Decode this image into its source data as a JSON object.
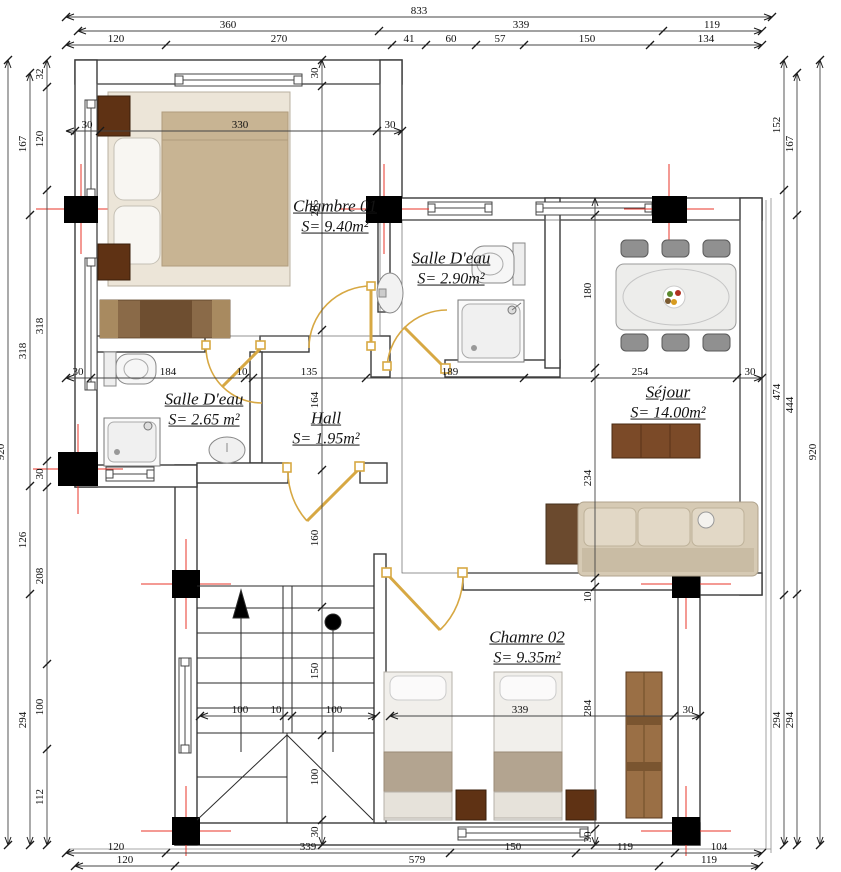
{
  "plan_title": "Floor plan",
  "rooms": [
    {
      "name": "Chambre 01",
      "area": "S= 9.40m²",
      "x": 335,
      "y": 217
    },
    {
      "name": "Salle D'eau",
      "area": "S= 2.90m²",
      "x": 451,
      "y": 269
    },
    {
      "name": "Séjour",
      "area": "S= 14.00m²",
      "x": 668,
      "y": 403
    },
    {
      "name": "Salle D'eau",
      "area": "S= 2.65 m²",
      "x": 204,
      "y": 410
    },
    {
      "name": "Hall",
      "area": "S= 1.95m²",
      "x": 326,
      "y": 429
    },
    {
      "name": "Chamre 02",
      "area": "S= 9.35m²",
      "x": 527,
      "y": 648
    }
  ],
  "colors": {
    "wall": "#3a3a3a",
    "column": "#000000",
    "axis_red": "#e8342a",
    "door": "#d7a843",
    "dim_line": "#444444",
    "dim_text": "#101010",
    "wood_dark": "#5f3214",
    "wood_mid": "#7b4a28",
    "wood_light": "#9a6f45",
    "fabric_beige": "#d6cab4",
    "blanket_tan": "#c8b493"
  },
  "dimensions": {
    "rows": [
      {
        "y": 17,
        "x1": 66,
        "x2": 772,
        "ticks": [
          66,
          772
        ],
        "labels": [
          {
            "p": 419,
            "t": "833"
          }
        ]
      },
      {
        "y": 31,
        "x1": 78,
        "x2": 762,
        "ticks": [
          78,
          379,
          663,
          762
        ],
        "labels": [
          {
            "p": 228,
            "t": "360"
          },
          {
            "p": 521,
            "t": "339"
          },
          {
            "p": 712,
            "t": "119"
          }
        ]
      },
      {
        "y": 45,
        "x1": 66,
        "x2": 762,
        "ticks": [
          66,
          166,
          392,
          426,
          476,
          524,
          650,
          762
        ],
        "labels": [
          {
            "p": 116,
            "t": "120"
          },
          {
            "p": 279,
            "t": "270"
          },
          {
            "p": 409,
            "t": "41"
          },
          {
            "p": 451,
            "t": "60"
          },
          {
            "p": 500,
            "t": "57"
          },
          {
            "p": 587,
            "t": "150"
          },
          {
            "p": 706,
            "t": "134"
          }
        ]
      },
      {
        "y": 131,
        "x1": 66,
        "x2": 402,
        "ticks": [
          75,
          100,
          377,
          402
        ],
        "labels": [
          {
            "p": 87,
            "t": "30"
          },
          {
            "p": 240,
            "t": "330"
          },
          {
            "p": 390,
            "t": "30"
          }
        ]
      },
      {
        "y": 378,
        "x1": 66,
        "x2": 762,
        "ticks": [
          66,
          91,
          245,
          253,
          366,
          524,
          737,
          762
        ],
        "labels": [
          {
            "p": 78,
            "t": "30"
          },
          {
            "p": 168,
            "t": "184"
          },
          {
            "p": 242,
            "t": "10"
          },
          {
            "p": 309,
            "t": "135"
          },
          {
            "p": 450,
            "t": "189"
          },
          {
            "p": 640,
            "t": "254"
          },
          {
            "p": 750,
            "t": "30"
          }
        ]
      },
      {
        "y": 716,
        "x1": 200,
        "x2": 376,
        "ticks": [
          200,
          284,
          292,
          376
        ],
        "labels": [
          {
            "p": 240,
            "t": "100"
          },
          {
            "p": 276,
            "t": "10"
          },
          {
            "p": 334,
            "t": "100"
          }
        ]
      },
      {
        "y": 716,
        "x1": 390,
        "x2": 700,
        "ticks": [
          390,
          674,
          700
        ],
        "labels": [
          {
            "p": 520,
            "t": "339"
          },
          {
            "p": 688,
            "t": "30"
          }
        ]
      },
      {
        "y": 853,
        "x1": 66,
        "x2": 762,
        "ticks": [
          66,
          166,
          450,
          576,
          675,
          762
        ],
        "labels": [
          {
            "p": 116,
            "t": "120"
          },
          {
            "p": 308,
            "t": "339"
          },
          {
            "p": 513,
            "t": "150"
          },
          {
            "p": 625,
            "t": "119"
          },
          {
            "p": 719,
            "t": "104"
          }
        ]
      },
      {
        "y": 866,
        "x1": 75,
        "x2": 759,
        "ticks": [
          75,
          175,
          659,
          759
        ],
        "labels": [
          {
            "p": 125,
            "t": "120"
          },
          {
            "p": 417,
            "t": "579"
          },
          {
            "p": 709,
            "t": "119"
          }
        ]
      }
    ],
    "cols": [
      {
        "x": 8,
        "y1": 60,
        "y2": 845,
        "ticks": [
          60,
          845
        ],
        "labels": [
          {
            "p": 452,
            "t": "920"
          }
        ]
      },
      {
        "x": 30,
        "y1": 73,
        "y2": 845,
        "ticks": [
          73,
          215,
          486,
          594,
          845
        ],
        "labels": [
          {
            "p": 144,
            "t": "167"
          },
          {
            "p": 351,
            "t": "318"
          },
          {
            "p": 540,
            "t": "126"
          },
          {
            "p": 720,
            "t": "294"
          }
        ]
      },
      {
        "x": 47,
        "y1": 60,
        "y2": 845,
        "ticks": [
          60,
          87,
          190,
          461,
          487,
          664,
          749,
          845
        ],
        "labels": [
          {
            "p": 74,
            "t": "32"
          },
          {
            "p": 139,
            "t": "120"
          },
          {
            "p": 326,
            "t": "318"
          },
          {
            "p": 474,
            "t": "30"
          },
          {
            "p": 576,
            "t": "208"
          },
          {
            "p": 707,
            "t": "100"
          },
          {
            "p": 797,
            "t": "112"
          }
        ]
      },
      {
        "x": 784,
        "y1": 60,
        "y2": 845,
        "ticks": [
          60,
          190,
          595,
          845
        ],
        "labels": [
          {
            "p": 125,
            "t": "152"
          },
          {
            "p": 392,
            "t": "474"
          },
          {
            "p": 720,
            "t": "294"
          }
        ]
      },
      {
        "x": 797,
        "y1": 73,
        "y2": 845,
        "ticks": [
          73,
          215,
          594,
          845
        ],
        "labels": [
          {
            "p": 144,
            "t": "167"
          },
          {
            "p": 405,
            "t": "444"
          },
          {
            "p": 720,
            "t": "294"
          }
        ]
      },
      {
        "x": 820,
        "y1": 60,
        "y2": 845,
        "ticks": [
          60,
          845
        ],
        "labels": [
          {
            "p": 452,
            "t": "920"
          }
        ]
      },
      {
        "x": 322,
        "y1": 60,
        "y2": 845,
        "ticks": [
          60,
          86,
          330,
          470,
          607,
          735,
          820,
          845
        ],
        "labels": [
          {
            "p": 73,
            "t": "30"
          },
          {
            "p": 208,
            "t": "285"
          },
          {
            "p": 400,
            "t": "164"
          },
          {
            "p": 538,
            "t": "160"
          },
          {
            "p": 671,
            "t": "150"
          },
          {
            "p": 777,
            "t": "100"
          },
          {
            "p": 832,
            "t": "30"
          }
        ]
      },
      {
        "x": 595,
        "y1": 198,
        "y2": 845,
        "ticks": [
          215,
          368,
          378,
          578,
          587,
          829,
          845
        ],
        "labels": [
          {
            "p": 291,
            "t": "180"
          },
          {
            "p": 478,
            "t": "234"
          },
          {
            "p": 597,
            "t": "10"
          },
          {
            "p": 708,
            "t": "284"
          },
          {
            "p": 837,
            "t": "30"
          }
        ]
      }
    ]
  }
}
